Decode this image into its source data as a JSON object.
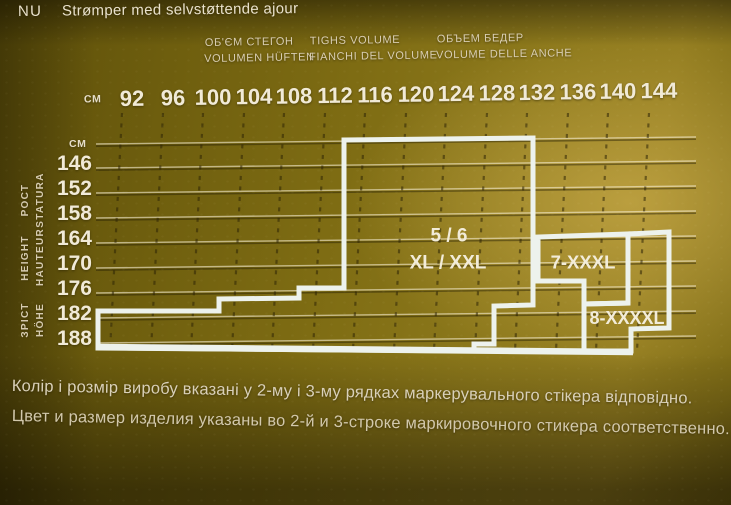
{
  "header": {
    "lang_code": "NU",
    "product_title": "Strømper med selvstøttende ajour"
  },
  "hip_header": {
    "row1": [
      "ОБ'ЄМ СТЕГОН",
      "TIGHS VOLUME",
      "ОБЪЕМ БЕДЕР"
    ],
    "row2": [
      "VOLUMEN HÜFTEN",
      "FIANCHI DEL VOLUME",
      "VOLUME DELLE ANCHE"
    ]
  },
  "chart_data": {
    "type": "area",
    "subtype": "hosiery-size-selection-grid",
    "title": "Height vs hip volume size chart",
    "x_axis": {
      "unit": "CM",
      "ticks": [
        "92",
        "96",
        "100",
        "104",
        "108",
        "112",
        "116",
        "120",
        "124",
        "128",
        "132",
        "136",
        "140",
        "144"
      ]
    },
    "y_axis": {
      "unit": "CM",
      "ticks": [
        "146",
        "152",
        "158",
        "164",
        "170",
        "176",
        "182",
        "188"
      ],
      "side_labels": [
        [
          "РОСТ",
          "STATURA"
        ],
        [
          "HEIGHT",
          "HAUTEUR"
        ],
        [
          "ЗРІСТ",
          "HÖHE"
        ]
      ]
    },
    "grid": {
      "rows_visible": true,
      "cols_dashed": true
    },
    "regions": [
      {
        "name": "size-region-5-6",
        "labels": [
          {
            "text": "5 / 6",
            "x": 449,
            "y": 236,
            "size": 19
          },
          {
            "text": "XL / XXL",
            "x": 448,
            "y": 263,
            "size": 19
          }
        ],
        "outline": [
          [
            344,
            140
          ],
          [
            533,
            138
          ],
          [
            533,
            305
          ],
          [
            494,
            306
          ],
          [
            494,
            344
          ],
          [
            474,
            344
          ],
          [
            474,
            351
          ],
          [
            98,
            348
          ],
          [
            98,
            311
          ],
          [
            219,
            311
          ],
          [
            219,
            299
          ],
          [
            299,
            298
          ],
          [
            299,
            288
          ],
          [
            344,
            288
          ]
        ]
      },
      {
        "name": "size-region-7-xxxl",
        "labels": [
          {
            "text": "7-XXXL",
            "x": 583,
            "y": 262,
            "size": 18.5
          }
        ],
        "outline": [
          [
            538,
            281
          ],
          [
            538,
            237
          ],
          [
            628,
            234
          ],
          [
            628,
            303
          ],
          [
            584,
            304
          ],
          [
            584,
            281
          ]
        ]
      },
      {
        "name": "size-region-8-xxxxl",
        "labels": [
          {
            "text": "8-XXXXL",
            "x": 627,
            "y": 318,
            "size": 18
          }
        ],
        "outline": [
          [
            584,
            304
          ],
          [
            628,
            303
          ],
          [
            628,
            234
          ],
          [
            669,
            232
          ],
          [
            669,
            328
          ],
          [
            631,
            329
          ],
          [
            631,
            351
          ],
          [
            584,
            351
          ]
        ]
      }
    ],
    "layout": {
      "grid": {
        "col_x": [
          122,
          163,
          203,
          244,
          284,
          325,
          365,
          406,
          446,
          487,
          527,
          568,
          608,
          649
        ],
        "col_y1": 113,
        "col_y2": 351,
        "col_tilt": -12,
        "row_y": [
          165,
          190,
          215,
          240,
          265,
          290,
          315,
          340
        ],
        "row_x1": 96,
        "row_x2": 696,
        "row_rise": 7,
        "top_border_y": 141
      },
      "x_label_center_y": 99,
      "x_label_dx": 10,
      "y_label_right": 92,
      "unit_top": {
        "x": 94,
        "y": 99
      },
      "unit_left": {
        "x": 79,
        "y": 144
      },
      "side_label_pos": [
        [
          26,
          200
        ],
        [
          41,
          200
        ],
        [
          26,
          258
        ],
        [
          41,
          258
        ],
        [
          26,
          320
        ],
        [
          41,
          320
        ]
      ],
      "baseline": [
        [
          97,
          347
        ],
        [
          633,
          352
        ]
      ]
    }
  },
  "footer": {
    "line1_uk": "Колір і розмір виробу вказані у 2-му і 3-му рядках маркерувального стікера відповідно.",
    "line2_ru": "Цвет и размер изделия указаны во 2-й и 3-строке маркировочного стикера соответственно."
  },
  "colors": {
    "outline_white": "#edf2ed",
    "grid_light": "rgba(246,238,214,0.60)",
    "grid_shadow": "rgba(35,28,2,0.45)",
    "col_dash": "rgba(45,36,5,0.55)",
    "region_label": "#f2ecd9",
    "text_cream": "#ece4cf",
    "bg_olive": "#7b690f",
    "bg_gold": "#a18a38"
  }
}
